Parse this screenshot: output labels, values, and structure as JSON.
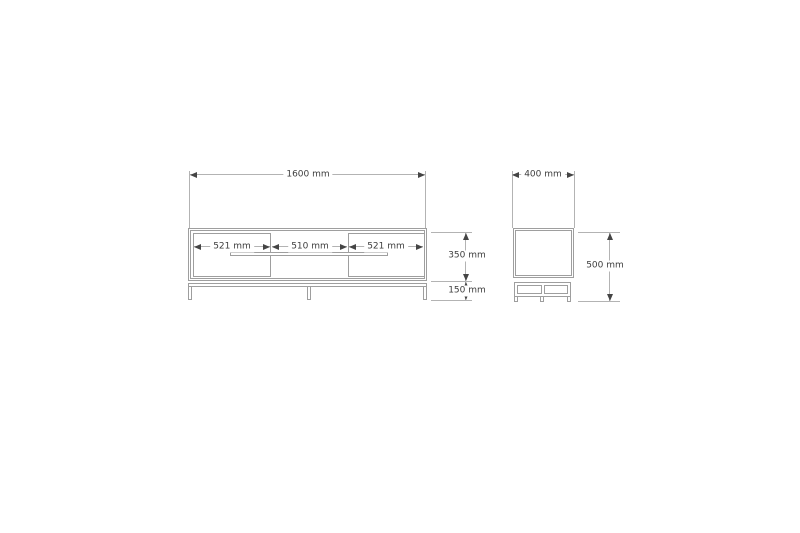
{
  "colors": {
    "background": "#ffffff",
    "furniture_line": "#9e9e9e",
    "dimension_line": "#b3b3b3",
    "arrow": "#454545",
    "text": "#3d3d3d"
  },
  "front_view": {
    "overall_width": "1600 mm",
    "left_door_width": "521 mm",
    "center_opening_width": "510 mm",
    "right_door_width": "521 mm",
    "cabinet_height": "350 mm",
    "leg_height": "150 mm"
  },
  "side_view": {
    "depth": "400 mm",
    "overall_height": "500 mm"
  }
}
